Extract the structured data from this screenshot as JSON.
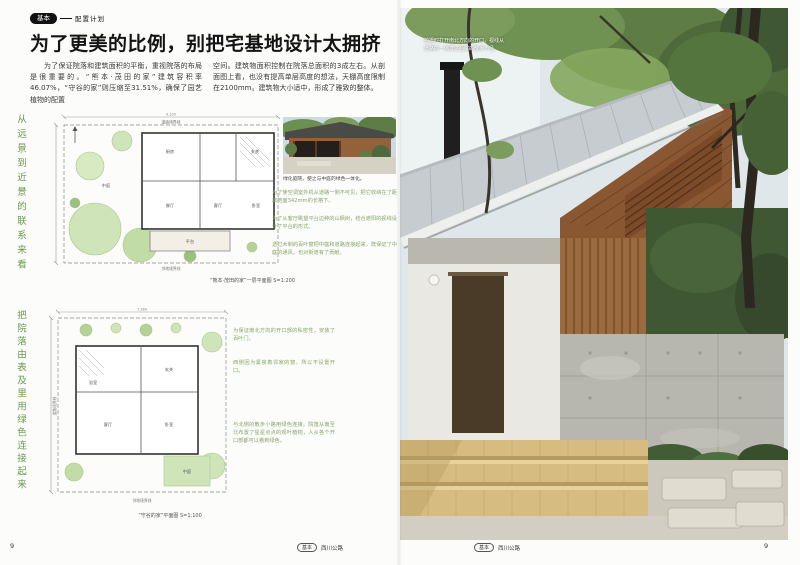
{
  "header": {
    "badge": "基本",
    "category": "配置计划",
    "title": "为了更美的比例，别把宅基地设计太拥挤"
  },
  "intro": {
    "col1": "为了保证院落和建筑面积的平衡，重视院落的布局是很重要的。“熊本·茂田的家”建筑容积率46.07%，“守谷的家”则压缩至31.51%，确保了园艺植物的配置",
    "col2": "空间。建筑物面积控制在院落总面积的3成左右。从剖面图上看，也没有提高单层高度的想法，天棚高度限制在2100mm。建筑物大小适中，形成了雅致的整体。"
  },
  "side_labels": {
    "top": "从远景到近景的联系来看",
    "bottom": "把院落由表及里用绿色连接起来"
  },
  "mini_photo": {
    "caption": "绿化庭院，使之与中庭的绿色一体化。"
  },
  "plan1": {
    "caption": "“熊本·茂田的家”一层平面图 S=1:200",
    "boundary_top": "道路境界线",
    "boundary_bottom": "邻地境界线",
    "dim_top": "9,100",
    "rooms": {
      "genkan": "玄关",
      "kitchen": "厨房",
      "dining": "餐厅",
      "living": "客厅",
      "bedroom": "卧室",
      "terrace": "平台",
      "court": "中庭"
    },
    "notes": [
      "为了使空调室外机从道路一侧不可见，把它收纳在了距离地面342mm的长格下。",
      "为了从客厅眺望平台边种的山枫树，结合遮阳的视线设计了平台的形式。",
      "透过木制的百叶窗把中庭和道路连接起来，既保证了中庭的通风，也对街道有了贡献。"
    ]
  },
  "plan2": {
    "caption": "“守谷的家”平面图 S=1:100",
    "boundary_bottom": "邻地境界线",
    "boundary_left": "道路境界线",
    "dim_top": "7,280",
    "rooms": {
      "genkan": "玄关",
      "living": "客厅",
      "bedroom": "卧室",
      "bath": "浴室",
      "court": "中庭"
    },
    "notes": [
      "为保证南北方向的开口部的私密性，安装了百叶门。",
      "西侧因为紧挨着邻家的窗，所以不设置开口。",
      "与北侧的散步小路用绿色连接。院落从南至北布置了星星点点的观叶植物，人从各个开口部都可以看到绿色。"
    ]
  },
  "main_photo": {
    "caption_line1": "拍摄时打开南北方向的开口，视线从",
    "caption_line2": "道路的一侧直达后院的散步小径。"
  },
  "footer": {
    "left_badge": "基本",
    "left_text": "西川公路",
    "left_page": "9",
    "right_badge": "基本",
    "right_text": "西川公路",
    "right_page": "9"
  },
  "colors": {
    "accent_green": "#6c9a4e",
    "note_green": "#88a56a",
    "tree_fill": "#cfe4b8"
  }
}
